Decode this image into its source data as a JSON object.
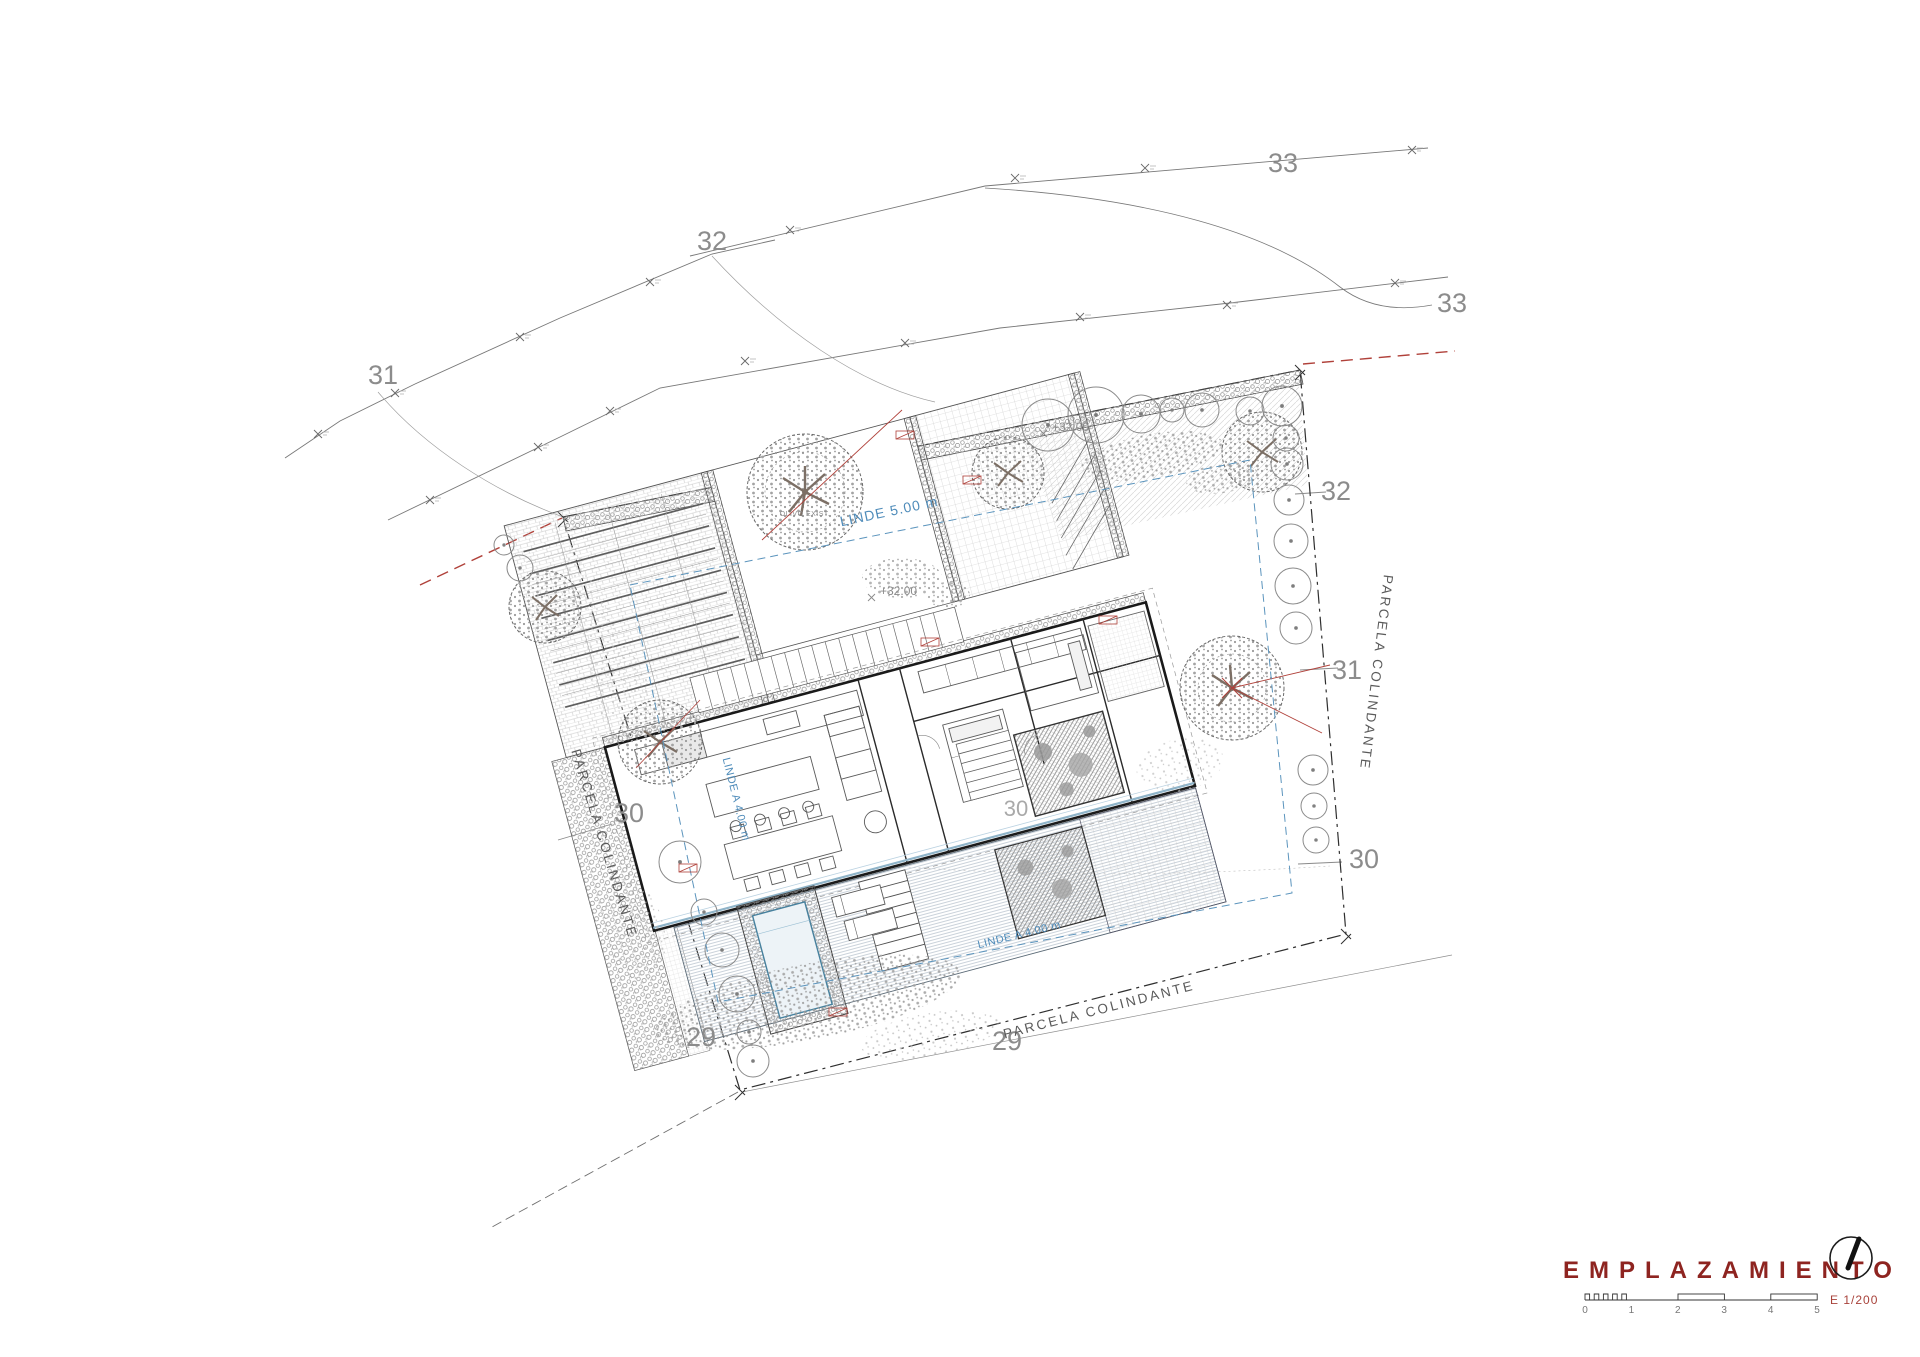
{
  "colors": {
    "title_red": "#8e2420",
    "annotation_red": "#b0413a",
    "setback_blue": "#4f8cba",
    "contour_gray": "#8c8c8c",
    "line_dark": "#2f2f2f"
  },
  "labels": {
    "contour_33_top": "33",
    "contour_33_right": "33",
    "contour_32_top": "32",
    "contour_31_left": "31",
    "contour_32_right": "32",
    "contour_31_right": "31",
    "contour_30_right": "30",
    "contour_30_left": "30",
    "contour_30_inner": "30",
    "contour_29_left": "29",
    "contour_29_right": "29"
  },
  "boundary": {
    "parcela_left": "PARCELA COLINDANTE",
    "parcela_right": "PARCELA COLINDANTE",
    "parcela_bottom": "PARCELA COLINDANTE"
  },
  "setbacks": {
    "linde_top": "LINDE 5.00 m",
    "linde_left": "LINDE A 4.00 m",
    "linde_bottom": "LINDE A 4.00 m"
  },
  "levels": {
    "plus_32_court": "+32.00",
    "plus_32_entry": "+32.00"
  },
  "trees": {
    "olivo_label": "OLIVO EXIST."
  },
  "title_block": {
    "title": "EMPLAZAMIENTO",
    "scale_text": "E 1/200",
    "scale_ticks": [
      "0",
      "1",
      "2",
      "3",
      "4",
      "5"
    ]
  }
}
